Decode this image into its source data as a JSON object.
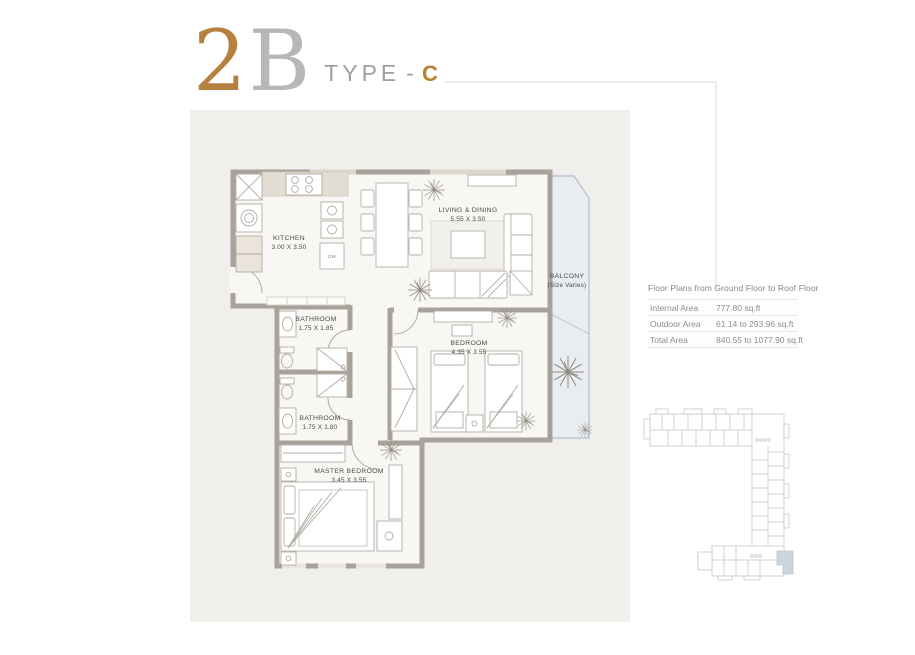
{
  "title": {
    "number": "2",
    "letter": "B",
    "type_label": "TYPE",
    "dash": "-",
    "type_code": "C"
  },
  "floor_plan": {
    "rooms": [
      {
        "id": "kitchen",
        "name": "KITCHEN",
        "dims": "3.00 X 3.50"
      },
      {
        "id": "living",
        "name": "LIVING & DINING",
        "dims": "5.55 X 3.50"
      },
      {
        "id": "balcony",
        "name": "BALCONY",
        "dims": "(Size Varies)"
      },
      {
        "id": "bathroom1",
        "name": "BATHROOM",
        "dims": "1.75 X 1.85"
      },
      {
        "id": "bedroom",
        "name": "BEDROOM",
        "dims": "4.35 X 3.55"
      },
      {
        "id": "bathroom2",
        "name": "BATHROOM",
        "dims": "1.75 X 1.80"
      },
      {
        "id": "master",
        "name": "MASTER BEDROOM",
        "dims": "3.45 X 3.55"
      }
    ],
    "fixtures": {
      "dishwasher_label": "DW"
    }
  },
  "area_table": {
    "header": "Floor Plans from Ground Floor to Roof Floor",
    "rows": [
      {
        "label": "Internal Area",
        "value": "777.80 sq.ft"
      },
      {
        "label": "Outdoor Area",
        "value": "61.14 to 293.96 sq.ft"
      },
      {
        "label": "Total Area",
        "value": "840.55 to 1077.90 sq.ft"
      }
    ]
  },
  "colors": {
    "accent_bronze": "#b5813e",
    "title_silver": "#b7b7b7",
    "wall": "#a8a29b",
    "panel_background": "#f1efec",
    "balcony_fill": "#e9edf1",
    "keyplan_highlight": "#ccd5dd"
  }
}
